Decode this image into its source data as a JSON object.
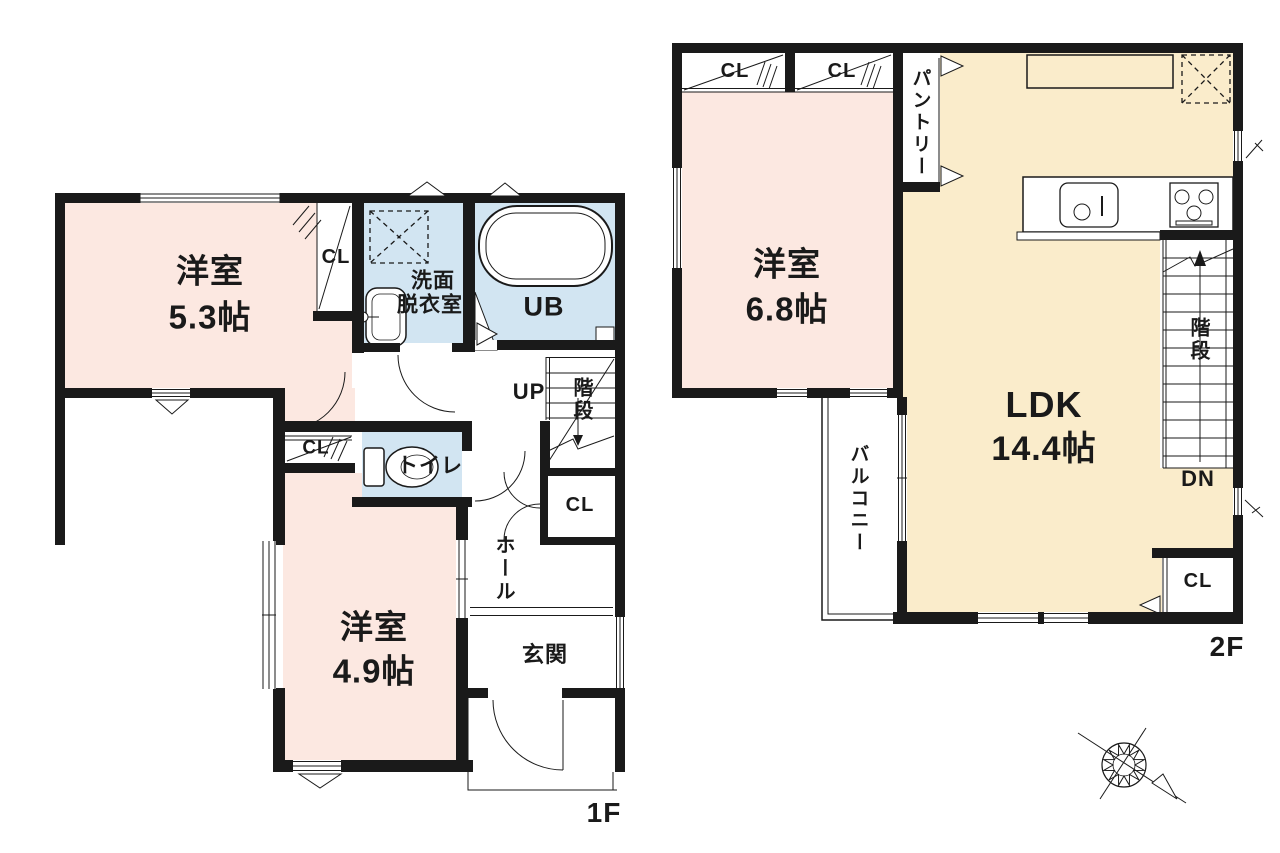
{
  "colors": {
    "wall": "#1a1a1a",
    "room_pink": "#fce8e1",
    "room_cream": "#faeccb",
    "room_blue": "#d2e5f2"
  },
  "floor1": {
    "floor_label": "1F",
    "room_53": {
      "name": "洋室",
      "size": "5.3帖"
    },
    "room_49": {
      "name": "洋室",
      "size": "4.9帖"
    },
    "washroom": {
      "line1": "洗面",
      "line2": "脱衣室"
    },
    "bath_label": "UB",
    "toilet_label": "トイレ",
    "closet_53_label": "CL",
    "closet_49_label": "CL",
    "closet_hall_label": "CL",
    "hall_label": "ホール",
    "entrance_label": "玄関",
    "stairs_label": "階段",
    "up_label": "UP"
  },
  "floor2": {
    "floor_label": "2F",
    "room_68": {
      "name": "洋室",
      "size": "6.8帖"
    },
    "ldk": {
      "name": "LDK",
      "size": "14.4帖"
    },
    "closet_left_label": "CL",
    "closet_right_label": "CL",
    "closet_ldk_label": "CL",
    "pantry_label": "パントリー",
    "balcony_label": "バルコニー",
    "stairs_label": "階段",
    "down_label": "DN"
  }
}
